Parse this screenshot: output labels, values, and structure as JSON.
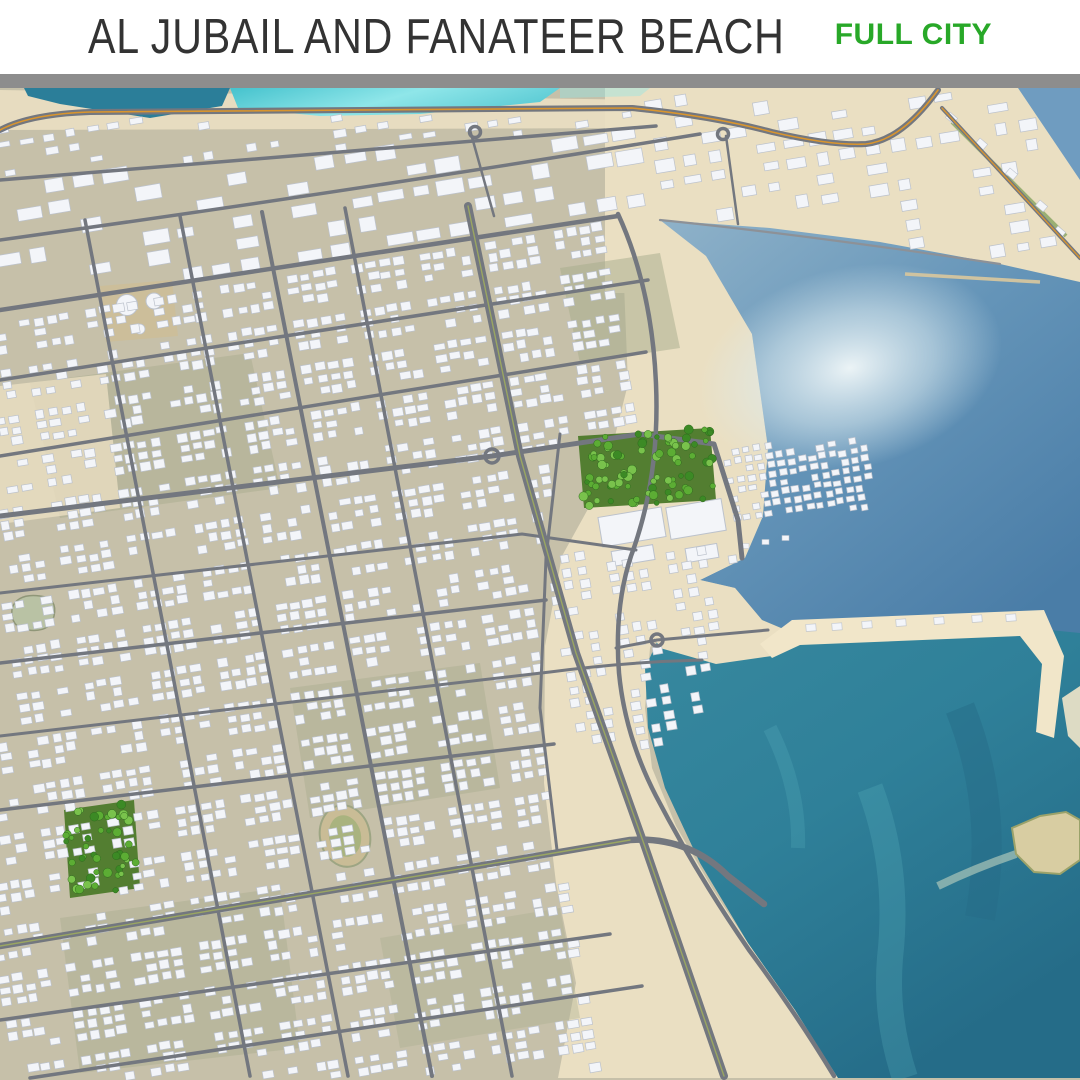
{
  "header": {
    "title": "AL JUBAIL AND FANATEER BEACH",
    "badge": "FULL CITY",
    "title_color": "#333333",
    "badge_color": "#28a828",
    "divider_color": "#8d8d8d",
    "background": "#ffffff"
  },
  "map": {
    "description": "3D aerial render of Al Jubail city grid and Fanateer beach coastline with bay, lagoon, marina pier, parks and offshore island",
    "features": [
      "arabian-gulf-bay",
      "fanateer-beach",
      "turquoise-lagoon",
      "harbor-water",
      "city-grid",
      "central-park",
      "neighborhood-park",
      "stadium",
      "marina-pier",
      "breakwater",
      "offshore-island",
      "coastal-highway",
      "industrial-zone",
      "storage-tanks",
      "shopping-compound"
    ],
    "colors": {
      "ground": "#c6c0a9",
      "patch_olive": "#a6ab8b",
      "patch_tan": "#cdbd96",
      "cream": "#eadfc2",
      "cream_bright": "#f1e6c9",
      "lagoon_a": "#45c2cd",
      "lagoon_b": "#8fe6e9",
      "harbor": "#2b7e99",
      "bay_a": "#8fb2c9",
      "bay_b": "#4a7da7",
      "sea_a": "#2f8099",
      "sea_b": "#256c88",
      "teal_light": "#63bfc8",
      "shimmer": "#f2f8f9",
      "island": "#d8cda2",
      "island_edge": "#9aa26a",
      "breakwater": "#cfc3a0",
      "road": "#73777f",
      "road_light": "#8d9197",
      "highway": "#d9952e",
      "median": "#9aa662",
      "building": "#f3f5f9",
      "building_edge": "#bcc2cc",
      "park": "#537e31",
      "tree1": "#3c8a25",
      "tree2": "#5cad34",
      "tree3": "#79c24c",
      "stadium_outer": "#c9bc96",
      "stadium_inner": "#a9b37f",
      "pond": "#b9c2a4",
      "green_strip": "#7f9f58"
    }
  }
}
